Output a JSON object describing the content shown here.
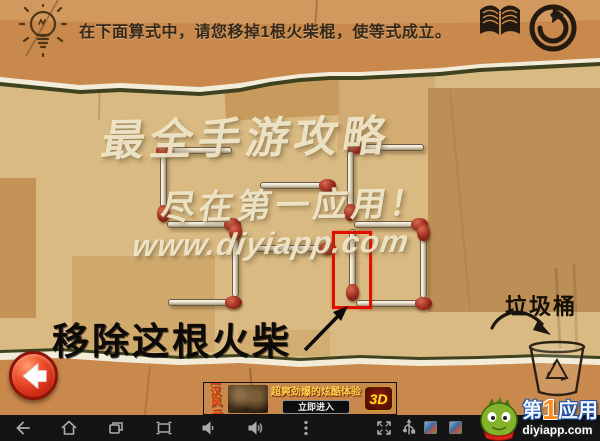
{
  "header": {
    "instruction": "在下面算式中，请您移掉1根火柴棍，使等式成立。",
    "icons": [
      "lightbulb-icon",
      "book-icon",
      "restart-icon"
    ]
  },
  "watermark": {
    "line1": "最全手游攻略",
    "line2": "尽在第一应用！",
    "line3": "www.diyiapp.com"
  },
  "puzzle": {
    "displayed_equation": "5=6",
    "annotation_label": "移除这根火柴",
    "trash_label": "垃圾桶",
    "matches": [
      {
        "part": "digit5-top",
        "x": 162,
        "y": 147,
        "dir": "h",
        "len": 70,
        "head": "start"
      },
      {
        "part": "digit5-upper-left",
        "x": 160,
        "y": 153,
        "dir": "v",
        "len": 63,
        "head": "end"
      },
      {
        "part": "digit5-middle",
        "x": 167,
        "y": 221,
        "dir": "h",
        "len": 68,
        "head": "end"
      },
      {
        "part": "digit5-lower-right",
        "x": 232,
        "y": 229,
        "dir": "v",
        "len": 68,
        "head": "start"
      },
      {
        "part": "digit5-bottom",
        "x": 168,
        "y": 299,
        "dir": "h",
        "len": 68,
        "head": "end"
      },
      {
        "part": "equals-top",
        "x": 260,
        "y": 182,
        "dir": "h",
        "len": 70,
        "head": "end"
      },
      {
        "part": "equals-bottom",
        "x": 255,
        "y": 245,
        "dir": "h",
        "len": 75,
        "head": "end"
      },
      {
        "part": "digit6-top",
        "x": 352,
        "y": 144,
        "dir": "h",
        "len": 72,
        "head": "start"
      },
      {
        "part": "digit6-upper-left",
        "x": 347,
        "y": 151,
        "dir": "v",
        "len": 64,
        "head": "end"
      },
      {
        "part": "digit6-middle",
        "x": 354,
        "y": 221,
        "dir": "h",
        "len": 68,
        "head": "end"
      },
      {
        "part": "digit6-lower-left",
        "x": 349,
        "y": 229,
        "dir": "v",
        "len": 66,
        "head": "end",
        "highlight": true
      },
      {
        "part": "digit6-lower-right",
        "x": 420,
        "y": 230,
        "dir": "v",
        "len": 68,
        "head": "start"
      },
      {
        "part": "digit6-bottom",
        "x": 356,
        "y": 300,
        "dir": "h",
        "len": 70,
        "head": "end"
      }
    ],
    "highlight_box": {
      "x": 332,
      "y": 231,
      "w": 40,
      "h": 78
    }
  },
  "ad": {
    "title_line1": "楚汉",
    "title_line2": "风云",
    "tagline": "超爽劲爆的炫酷体验",
    "cta": "立即进入",
    "badge": "3D"
  },
  "branding": {
    "prefix": "第",
    "number": "1",
    "suffix": "应用",
    "domain": "diyiapp.com"
  },
  "navbar": {
    "icons": [
      "back",
      "home",
      "recents",
      "screenshot",
      "volume-down",
      "volume-up",
      "menu",
      "fullscreen",
      "usb",
      "app-thumb-1",
      "app-thumb-2"
    ]
  },
  "colors": {
    "paper_orange": "#c9894d",
    "board_tan": "#d9ba82",
    "tear_shadow": "#3e421f",
    "tear_white": "#f3ecd9",
    "highlight_red": "#e01000",
    "watermark_cream": "#f3eace",
    "navbar_black": "#141414",
    "back_button_red": "#cf2a15",
    "match_head_red": "#a33124"
  }
}
